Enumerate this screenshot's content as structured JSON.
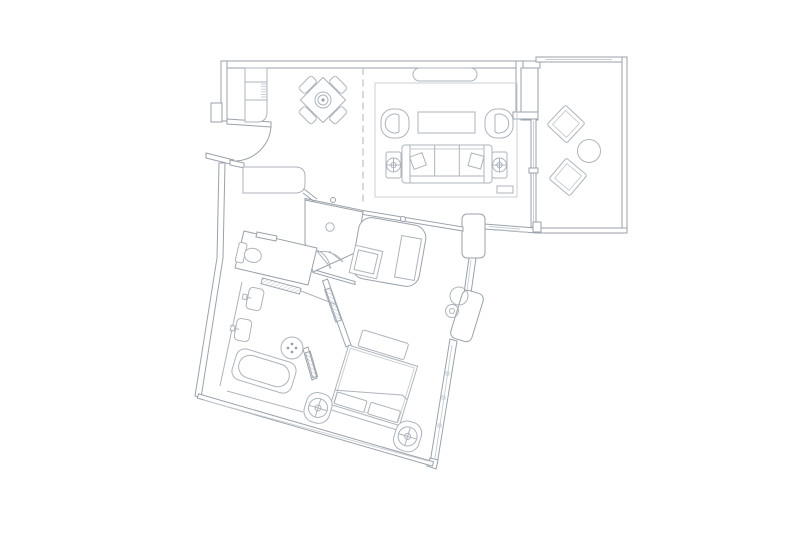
{
  "meta": {
    "title": "hotel-suite-floor-plan",
    "type": "architectural line drawing, plan view, no text labels",
    "canvas": {
      "width": 800,
      "height": 533
    }
  },
  "palette": {
    "background": "#ffffff",
    "wall_line": "#9aa2ab",
    "furniture_line": "#adb4bc",
    "detail_line": "#c6ccd2",
    "divider_dash": "#b4bac1"
  },
  "rooms": [
    {
      "id": "entry-foyer",
      "label": "Entry foyer",
      "features": [
        "entry door with swing arc",
        "tall wardrobe cabinet with shelves",
        "wall niche"
      ]
    },
    {
      "id": "dining-area",
      "label": "Dining area",
      "features": [
        "square table rotated 45 degrees",
        "lazy-susan center rings",
        "4 dining chairs",
        "dashed zone divider"
      ]
    },
    {
      "id": "living-room",
      "label": "Living room",
      "features": [
        "area rug",
        "media credenza",
        "2 barrel armchairs",
        "coffee table",
        "3-seat sofa",
        "2 throw pillows",
        "2 side tables with lamps",
        "floor vent"
      ]
    },
    {
      "id": "balcony",
      "label": "Balcony terrace",
      "features": [
        "2 diamond lounge chairs",
        "round side table",
        "sliding glass door",
        "glazed wall"
      ]
    },
    {
      "id": "dressing-area",
      "label": "Dressing area",
      "features": [
        "pentagonal closet with ceiling light",
        "built-in wardrobe",
        "ottoman",
        "cabinet",
        "mirrored sliding panels",
        "door pivots"
      ]
    },
    {
      "id": "water-closet",
      "label": "Water closet",
      "features": [
        "toilet with tank",
        "door swing"
      ]
    },
    {
      "id": "bathroom",
      "label": "Bathroom",
      "features": [
        "vanity counter with 2 sinks",
        "bathtub with inner basin",
        "round bath stool with drain dots",
        "mirror panel"
      ]
    },
    {
      "id": "bedroom",
      "label": "Bedroom",
      "features": [
        "king bed with duvet fold",
        "2 headboard pillow panels",
        "foot bench",
        "2 rounded nightstands with lamps",
        "angled window wall with mullions"
      ]
    }
  ],
  "structure": {
    "zones": [
      "orthogonal upper zone",
      "rotated lower zone (10-17 degrees)"
    ],
    "elements": [
      "double-line exterior walls",
      "interior shaft column",
      "rounded wall piers",
      "window glazing strips",
      "dashed living/dining divider"
    ]
  }
}
